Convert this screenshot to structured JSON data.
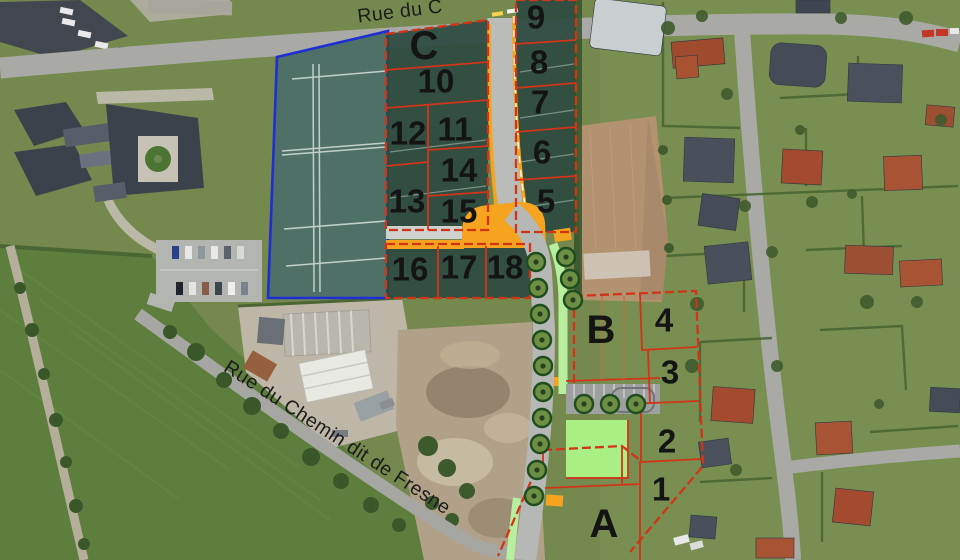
{
  "streets": {
    "top": {
      "name": "Rue du C"
    },
    "diagonal": {
      "name": "Rue du Chemin dit de Fresne"
    }
  },
  "zones": [
    {
      "label": "A"
    },
    {
      "label": "B"
    },
    {
      "label": "C"
    }
  ],
  "plots": [
    {
      "label": "1"
    },
    {
      "label": "2"
    },
    {
      "label": "3"
    },
    {
      "label": "4"
    },
    {
      "label": "5"
    },
    {
      "label": "6"
    },
    {
      "label": "7"
    },
    {
      "label": "8"
    },
    {
      "label": "9"
    },
    {
      "label": "10"
    },
    {
      "label": "11"
    },
    {
      "label": "12"
    },
    {
      "label": "13"
    },
    {
      "label": "14"
    },
    {
      "label": "15"
    },
    {
      "label": "16"
    },
    {
      "label": "17"
    },
    {
      "label": "18"
    }
  ],
  "colors": {
    "plot_line_red": "#d23418",
    "boundary_blue": "#1e2ed6",
    "road_orange": "#f6a31f",
    "verge_green": "#b7ef9e",
    "lawn_green": "#a9ef83",
    "overlay_green": "#2d4a41",
    "field_teal": "#4e7066"
  }
}
